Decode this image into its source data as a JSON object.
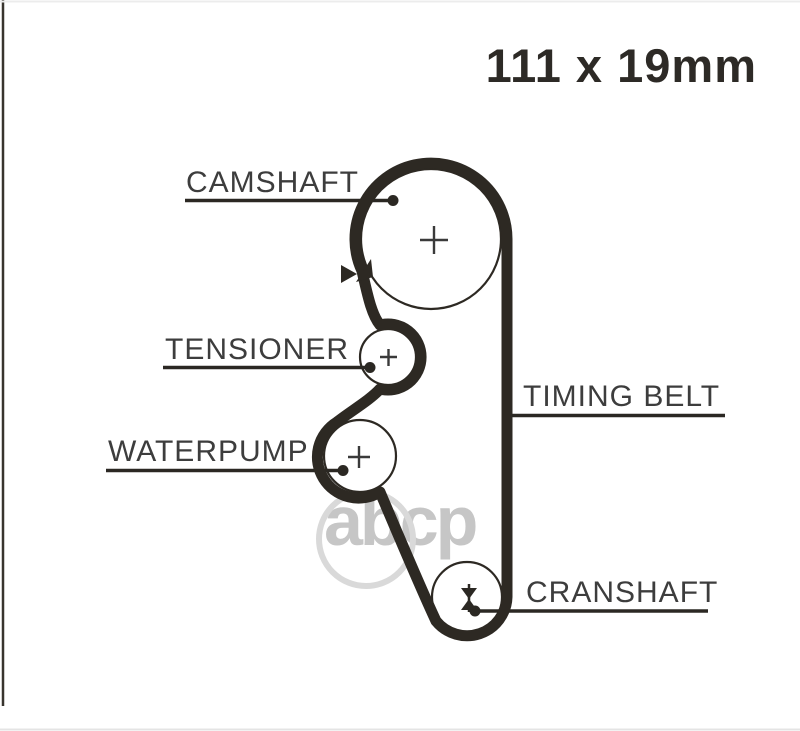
{
  "size_label": "111 x 19mm",
  "labels": {
    "camshaft": "CAMSHAFT",
    "tensioner": "TENSIONER",
    "waterpump": "WATERPUMP",
    "timing_belt": "TIMING BELT",
    "crankshaft": "CRANSHAFT"
  },
  "watermark": {
    "text": "abcp"
  },
  "colors": {
    "background": "#ffffff",
    "belt_line": "#2d2923",
    "leader_line": "#2b2823",
    "label_text": "#3d3d3d",
    "title_text": "#2d2a26",
    "watermark_gray": "#c6c6c6"
  }
}
